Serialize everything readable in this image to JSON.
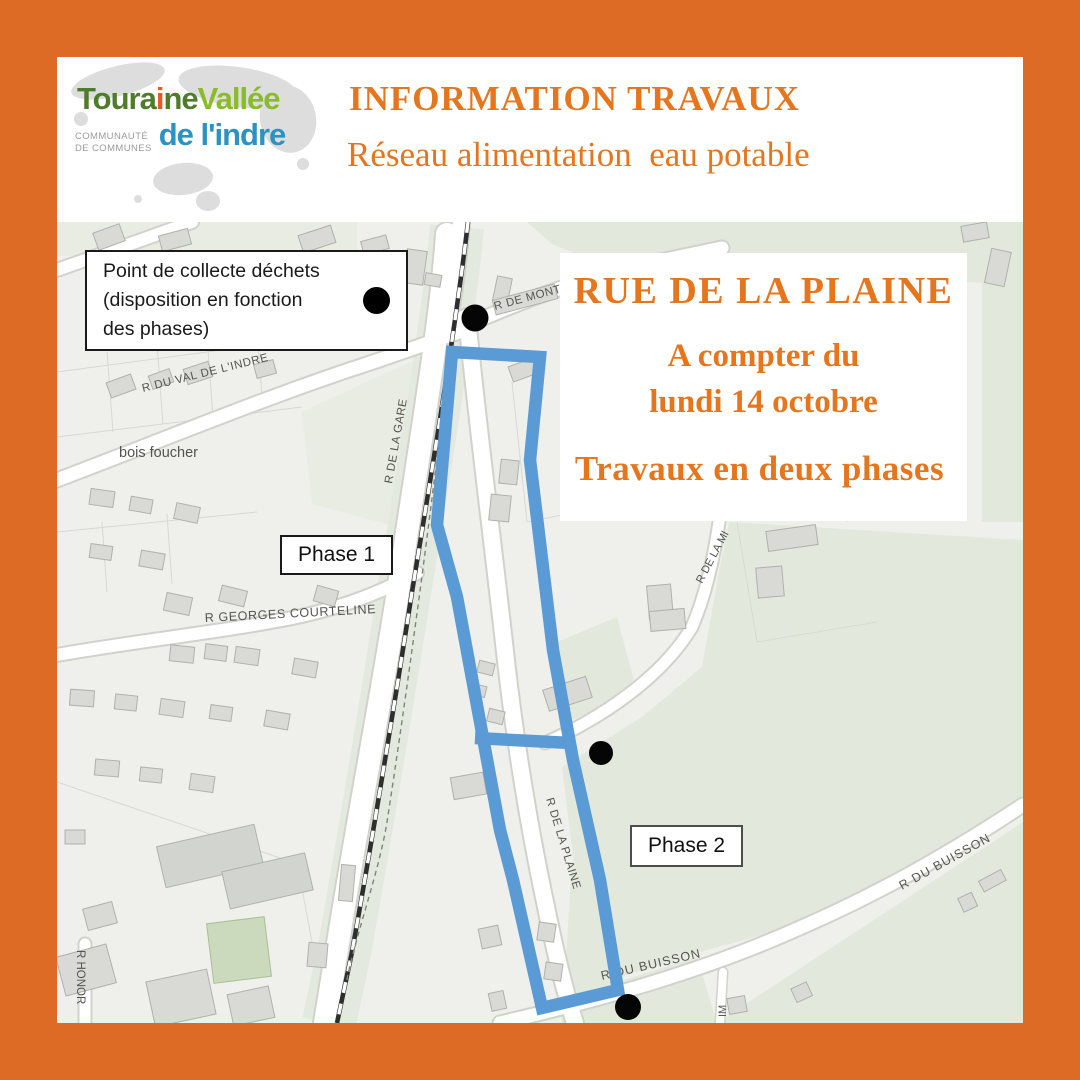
{
  "logo": {
    "word1_pre": "Toura",
    "word1_accent": "i",
    "word1_post": "ne",
    "word2": "Vallée",
    "sub_line1": "COMMUNAUTÉ",
    "sub_line2": "DE COMMUNES",
    "word3": "de l'indre"
  },
  "header": {
    "title": "INFORMATION TRAVAUX",
    "subtitle": "Réseau alimentation  eau potable",
    "accent_color": "#e5761e"
  },
  "announcement": {
    "street": "RUE DE LA PLAINE",
    "date_line1": "A compter du",
    "date_line2": "lundi 14 octobre",
    "phases": "Travaux en deux phases"
  },
  "legend": {
    "lines": [
      "Point de collecte déchets",
      "(disposition en fonction",
      "des phases)"
    ]
  },
  "phase_labels": {
    "phase1": "Phase 1",
    "phase2": "Phase 2"
  },
  "map": {
    "street_labels": {
      "r_de_mont": "R DE MONT",
      "r_du_val": "R DU VAL DE L'INDRE",
      "bois_foucher": "bois foucher",
      "r_de_la_gare": "R DE LA GARE",
      "r_georges": "R GEORGES COURTELINE",
      "r_de_la_m": "R DE LA MI",
      "r_de_la_plaine": "R DE LA PLAINE",
      "r_du_buisson_bottom": "R DU BUISSON",
      "r_du_buisson_right": "R DU BUISSON",
      "r_honore": "R HONOR",
      "impasse": "IM"
    },
    "colors": {
      "work_zone": "#5b9bd5",
      "marker": "#000000",
      "border": "#dd6b26"
    }
  }
}
